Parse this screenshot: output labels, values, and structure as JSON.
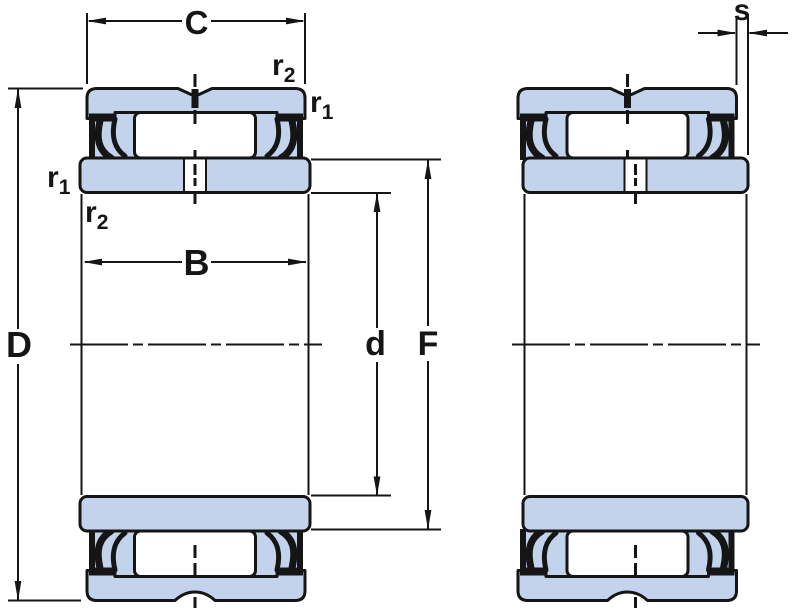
{
  "diagram": {
    "figure": "bearing-cross-section-two-views",
    "colors": {
      "ring_fill": "#c2d3eb",
      "line": "#151515",
      "roller_fill": "#ffffff",
      "background": "#ffffff"
    },
    "labels": {
      "outer_ring_width": "C",
      "inner_ring_width": "B",
      "outside_diameter": "D",
      "bore_diameter": "d",
      "flange_diameter": "F",
      "ring_offset": "s",
      "r_base": "r",
      "sub1": "1",
      "sub2": "2"
    }
  }
}
